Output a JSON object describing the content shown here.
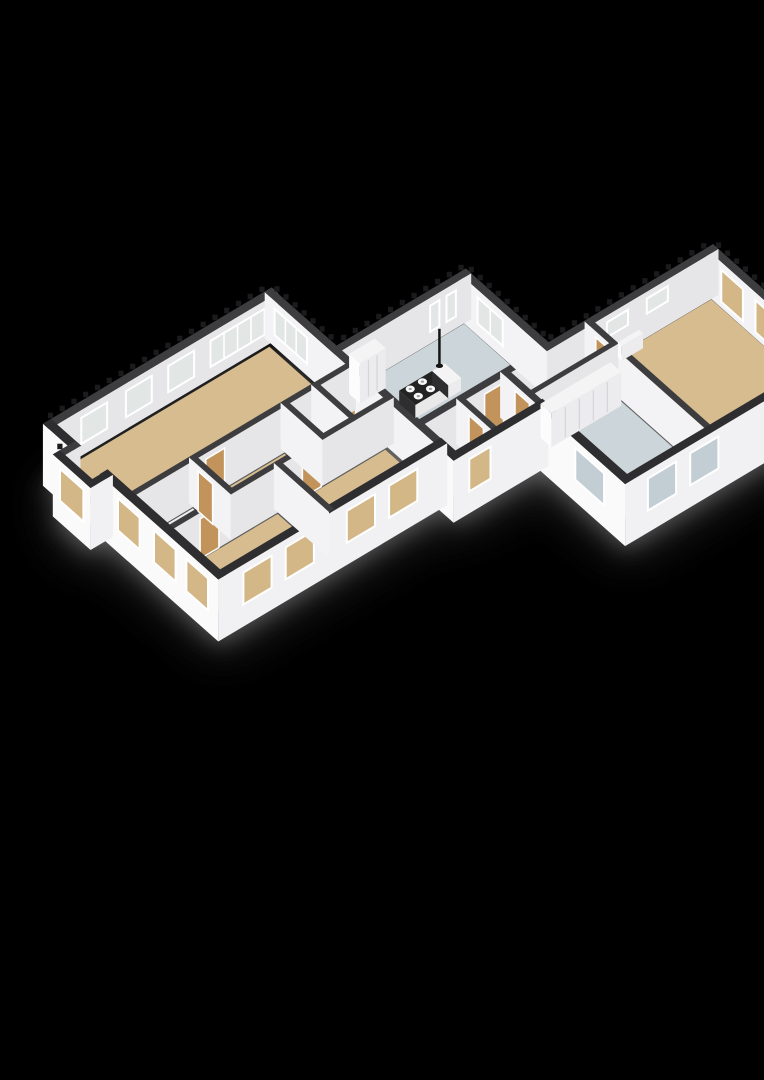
{
  "meta": {
    "label": "3D isometric floor plan render on black background"
  },
  "scene": {
    "width": 764,
    "height": 1080,
    "background": "#000000",
    "projection": {
      "origin": [
        50,
        470
      ],
      "u": [
        23.5,
        -14
      ],
      "v": [
        18,
        16
      ],
      "wall_height": 46,
      "slab_depth": 16
    },
    "colors": {
      "bg": "#000000",
      "shadow": "#8e8e8e",
      "band_ext": "#2e2e30",
      "band_int": "#3d3d3f",
      "teeth": "#1b1b1d",
      "face_se": "#e6e6e8",
      "face_sw": "#f3f3f5",
      "outer_se": "#f1f1f3",
      "outer_sw": "#fafafb",
      "tan": "#d7bc8f",
      "blue": "#ccd5da",
      "white": "#ededee",
      "win_tan": "#d3b787",
      "win_blue": "#c3ced4",
      "glass": "#e2e6e4",
      "frame": "#ffffff",
      "door": "#c2945c",
      "seam": "#d5d5d8",
      "island_top": "#232323",
      "island_sw": "#2e2e30",
      "island_se": "#e9e9ea",
      "furn_top": "#f4f4f5",
      "furn_sw": "#fcfcfd",
      "furn_se": "#ececee",
      "burner": "#f8f8f8",
      "pendant": "#151515"
    },
    "shadow": {
      "dy": 18,
      "opacity": 0.5,
      "rects": [
        [
          -0.9,
          1.2,
          0.2,
          3.3
        ],
        [
          -0.2,
          -0.2,
          9.6,
          9.65
        ],
        [
          9.4,
          3.4,
          15.15,
          8.4
        ],
        [
          9.4,
          8.0,
          13.3,
          10.45
        ],
        [
          12.9,
          8.0,
          22.2,
          15.15
        ]
      ]
    },
    "rooms": [
      {
        "id": "living-room",
        "rect": [
          0.28,
          0.28,
          9.12,
          4.28
        ],
        "floor": "tan"
      },
      {
        "id": "bathroom",
        "rect": [
          0.28,
          4.62,
          2.54,
          6.38
        ],
        "floor": "white"
      },
      {
        "id": "hallway",
        "rect": [
          2.86,
          4.62,
          6.44,
          6.38
        ],
        "floor": "tan"
      },
      {
        "id": "closet-a",
        "rect": [
          6.76,
          4.62,
          7.74,
          6.38
        ],
        "floor": "white"
      },
      {
        "id": "closet-b",
        "rect": [
          8.06,
          4.62,
          9.12,
          6.38
        ],
        "floor": "tan"
      },
      {
        "id": "bedroom-1",
        "rect": [
          0.28,
          6.72,
          4.54,
          9.12
        ],
        "floor": "tan"
      },
      {
        "id": "bedroom-2",
        "rect": [
          4.86,
          6.72,
          9.12,
          9.12
        ],
        "floor": "tan"
      },
      {
        "id": "bay-nook",
        "rect": [
          -0.48,
          1.5,
          0.1,
          3.0
        ],
        "floor": "tan"
      },
      {
        "id": "kitchen",
        "rect": [
          9.56,
          3.76,
          14.74,
          8.04
        ],
        "floor": "blue"
      },
      {
        "id": "rear-hall",
        "rect": [
          9.56,
          8.36,
          12.94,
          10.04
        ],
        "floor": "tan"
      },
      {
        "id": "wing-hall",
        "rect": [
          13.26,
          8.36,
          16.52,
          9.39
        ],
        "floor": "tan"
      },
      {
        "id": "storage-room",
        "rect": [
          13.26,
          9.71,
          16.52,
          14.74
        ],
        "floor": "blue"
      },
      {
        "id": "garage-room",
        "rect": [
          16.84,
          8.36,
          21.74,
          14.74
        ],
        "floor": "tan"
      }
    ],
    "walls": [
      {
        "id": "c-ne",
        "seg": [
          21.9,
          8.2,
          21.9,
          14.9
        ],
        "t": 0.3,
        "style": "inner",
        "teeth": [
          0,
          6.7
        ],
        "windows": [
          {
            "a": 0.7,
            "b": 1.9,
            "f": "win_tan"
          },
          {
            "a": 2.6,
            "b": 3.8,
            "f": "win_tan"
          }
        ]
      },
      {
        "id": "c-nw",
        "seg": [
          9.4,
          8.2,
          21.9,
          8.2
        ],
        "t": 0.3,
        "style": "inner",
        "teeth": [
          5.6,
          12.5
        ],
        "windows": [
          {
            "a": 7.9,
            "b": 8.8,
            "f": "glass",
            "short": true
          },
          {
            "a": 9.6,
            "b": 10.5,
            "f": "glass",
            "short": true
          }
        ],
        "doors": [
          {
            "a": 2.7,
            "b": 3.5
          }
        ]
      },
      {
        "id": "b-ne",
        "seg": [
          14.9,
          3.6,
          14.9,
          8.2
        ],
        "t": 0.3,
        "style": "inner",
        "teeth": [
          0,
          4.6
        ],
        "windows": [
          {
            "a": 0.9,
            "b": 2.3,
            "f": "glass",
            "m": 1
          }
        ]
      },
      {
        "id": "b-nw",
        "seg": [
          9.4,
          3.6,
          14.9,
          3.6
        ],
        "t": 0.3,
        "style": "inner",
        "teeth": [
          0.3,
          5.5
        ],
        "windows": [
          {
            "a": 3.9,
            "b": 4.3,
            "f": "glass"
          },
          {
            "a": 4.6,
            "b": 5.0,
            "f": "glass"
          }
        ]
      },
      {
        "id": "a-nw",
        "seg": [
          0,
          0,
          9.4,
          0
        ],
        "t": 0.34,
        "style": "inner",
        "teeth": [
          0,
          9.4
        ],
        "windows": [
          {
            "a": 1.2,
            "b": 2.3,
            "f": "glass"
          },
          {
            "a": 3.1,
            "b": 4.2,
            "f": "glass"
          },
          {
            "a": 4.9,
            "b": 6.0,
            "f": "glass"
          },
          {
            "a": 6.7,
            "b": 9.0,
            "f": "glass",
            "m": 3
          }
        ]
      },
      {
        "id": "a-ne",
        "seg": [
          9.4,
          0,
          9.4,
          9.4
        ],
        "t": 0.3,
        "style": "inner",
        "teeth": [
          0,
          3.3
        ],
        "windows": [
          {
            "a": 0.4,
            "b": 2.2,
            "f": "glass",
            "m": 2
          }
        ],
        "doors": [
          {
            "a": 4.1,
            "b": 4.9
          }
        ]
      },
      {
        "id": "c-int-1",
        "seg": [
          16.68,
          8.2,
          16.68,
          14.9
        ],
        "t": 0.24,
        "style": "inner",
        "doors": [
          {
            "a": 0.5,
            "b": 1.3
          }
        ]
      },
      {
        "id": "c-int-2",
        "seg": [
          13.1,
          9.55,
          16.68,
          9.55
        ],
        "t": 0.22,
        "style": "inner"
      },
      {
        "id": "c-se",
        "seg": [
          13.1,
          14.9,
          21.9,
          14.9
        ],
        "t": 0.34,
        "style": "outer",
        "windows": [
          {
            "a": 0.8,
            "b": 2.0,
            "f": "win_blue"
          },
          {
            "a": 2.6,
            "b": 3.8,
            "f": "win_blue"
          }
        ]
      },
      {
        "id": "a-int-1",
        "seg": [
          0.28,
          4.45,
          9.4,
          4.45
        ],
        "t": 0.24,
        "style": "inner",
        "doors": [
          {
            "a": 2.85,
            "b": 3.65
          }
        ]
      },
      {
        "id": "c-sw-int",
        "seg": [
          13.1,
          8.2,
          13.1,
          10.2
        ],
        "t": 0.26,
        "style": "inner",
        "doors": [
          {
            "a": 0.7,
            "b": 1.5
          }
        ]
      },
      {
        "id": "a-int-5",
        "seg": [
          7.9,
          4.45,
          7.9,
          6.55
        ],
        "t": 0.22,
        "style": "inner"
      },
      {
        "id": "d-int",
        "seg": [
          11.2,
          8.2,
          11.2,
          10.2
        ],
        "t": 0.22,
        "style": "inner",
        "doors": [
          {
            "a": 0.6,
            "b": 1.4
          }
        ]
      },
      {
        "id": "c-sw-ext",
        "seg": [
          13.1,
          10.2,
          13.1,
          14.9
        ],
        "t": 0.34,
        "style": "outer",
        "windows": [
          {
            "a": 2.1,
            "b": 3.7,
            "f": "win_blue"
          }
        ]
      },
      {
        "id": "d-se",
        "seg": [
          9.4,
          10.2,
          13.1,
          10.2
        ],
        "t": 0.34,
        "style": "outer",
        "windows": [
          {
            "a": 0.5,
            "b": 1.4,
            "f": "win_tan"
          }
        ]
      },
      {
        "id": "a-int-2",
        "seg": [
          0.28,
          6.55,
          9.4,
          6.55
        ],
        "t": 0.24,
        "style": "inner",
        "doors": [
          {
            "a": 1.0,
            "b": 1.8
          },
          {
            "a": 5.35,
            "b": 6.15
          }
        ]
      },
      {
        "id": "a-int-4",
        "seg": [
          6.6,
          4.45,
          6.6,
          6.55
        ],
        "t": 0.22,
        "style": "inner"
      },
      {
        "id": "d-step",
        "seg": [
          9.4,
          9.4,
          9.4,
          10.2
        ],
        "t": 0.34,
        "style": "outer"
      },
      {
        "id": "a-se",
        "seg": [
          0,
          9.4,
          9.4,
          9.4
        ],
        "t": 0.34,
        "style": "outer",
        "windows": [
          {
            "a": 0.9,
            "b": 2.1,
            "f": "win_tan"
          },
          {
            "a": 2.7,
            "b": 3.9,
            "f": "win_tan"
          },
          {
            "a": 5.3,
            "b": 6.5,
            "f": "win_tan"
          },
          {
            "a": 7.1,
            "b": 8.3,
            "f": "win_tan"
          }
        ]
      },
      {
        "id": "a-sw-1",
        "seg": [
          0,
          0,
          0,
          1.35
        ],
        "t": 0.34,
        "style": "outer"
      },
      {
        "id": "bay-nw",
        "seg": [
          -0.65,
          1.35,
          0,
          1.35
        ],
        "t": 0.3,
        "style": "inner",
        "teeth": [
          0,
          0.65
        ]
      },
      {
        "id": "a-int-3",
        "seg": [
          2.7,
          4.45,
          2.7,
          6.55
        ],
        "t": 0.22,
        "style": "inner",
        "doors": [
          {
            "a": 0.4,
            "b": 1.2
          }
        ]
      },
      {
        "id": "a-int-6",
        "seg": [
          4.7,
          6.55,
          4.7,
          9.4
        ],
        "t": 0.22,
        "style": "inner"
      },
      {
        "id": "bay-sw",
        "seg": [
          -0.65,
          1.35,
          -0.65,
          3.15
        ],
        "t": 0.3,
        "style": "outer",
        "windows": [
          {
            "a": 0.25,
            "b": 1.55,
            "f": "win_tan"
          }
        ]
      },
      {
        "id": "a-sw-2",
        "seg": [
          0,
          3.15,
          0,
          9.4
        ],
        "t": 0.34,
        "style": "outer",
        "windows": [
          {
            "a": 0.85,
            "b": 2.05,
            "f": "win_tan"
          },
          {
            "a": 2.85,
            "b": 4.05,
            "f": "win_tan"
          },
          {
            "a": 4.65,
            "b": 5.85,
            "f": "win_tan"
          }
        ]
      },
      {
        "id": "bay-se",
        "seg": [
          -0.65,
          3.15,
          0,
          3.15
        ],
        "t": 0.3,
        "style": "outer"
      }
    ],
    "furniture": [
      {
        "id": "kitchen-cabinet",
        "type": "box",
        "rect": [
          9.8,
          3.82,
          10.9,
          4.42
        ],
        "h": 40,
        "top": "furn_top",
        "sw": "furn_sw",
        "se": "furn_se",
        "seams": 2
      },
      {
        "id": "kitchen-island",
        "type": "box",
        "rect": [
          10.8,
          5.3,
          12.2,
          6.2
        ],
        "h": 13,
        "top": "island_top",
        "sw": "island_sw",
        "se": "island_se",
        "burners": [
          [
            11.1,
            5.52
          ],
          [
            11.1,
            5.97
          ],
          [
            11.62,
            5.52
          ],
          [
            11.62,
            5.97
          ]
        ]
      },
      {
        "id": "island-counter",
        "type": "box",
        "rect": [
          12.2,
          5.3,
          12.74,
          6.2
        ],
        "h": 13,
        "top": "furn_top",
        "sw": "island_sw",
        "se": "furn_se"
      },
      {
        "id": "storage-closets",
        "type": "box",
        "rect": [
          13.42,
          9.73,
          16.4,
          10.33
        ],
        "h": 34,
        "top": "furn_top",
        "sw": "furn_sw",
        "se": "furn_se",
        "seams": 4
      },
      {
        "id": "garage-radiator",
        "type": "box",
        "rect": [
          17.7,
          8.44,
          18.6,
          8.66
        ],
        "h": 15,
        "top": "furn_top",
        "sw": "furn_sw",
        "se": "furn_se"
      },
      {
        "id": "island-pendant",
        "type": "pendant",
        "at": [
          12.42,
          5.42
        ]
      }
    ]
  }
}
